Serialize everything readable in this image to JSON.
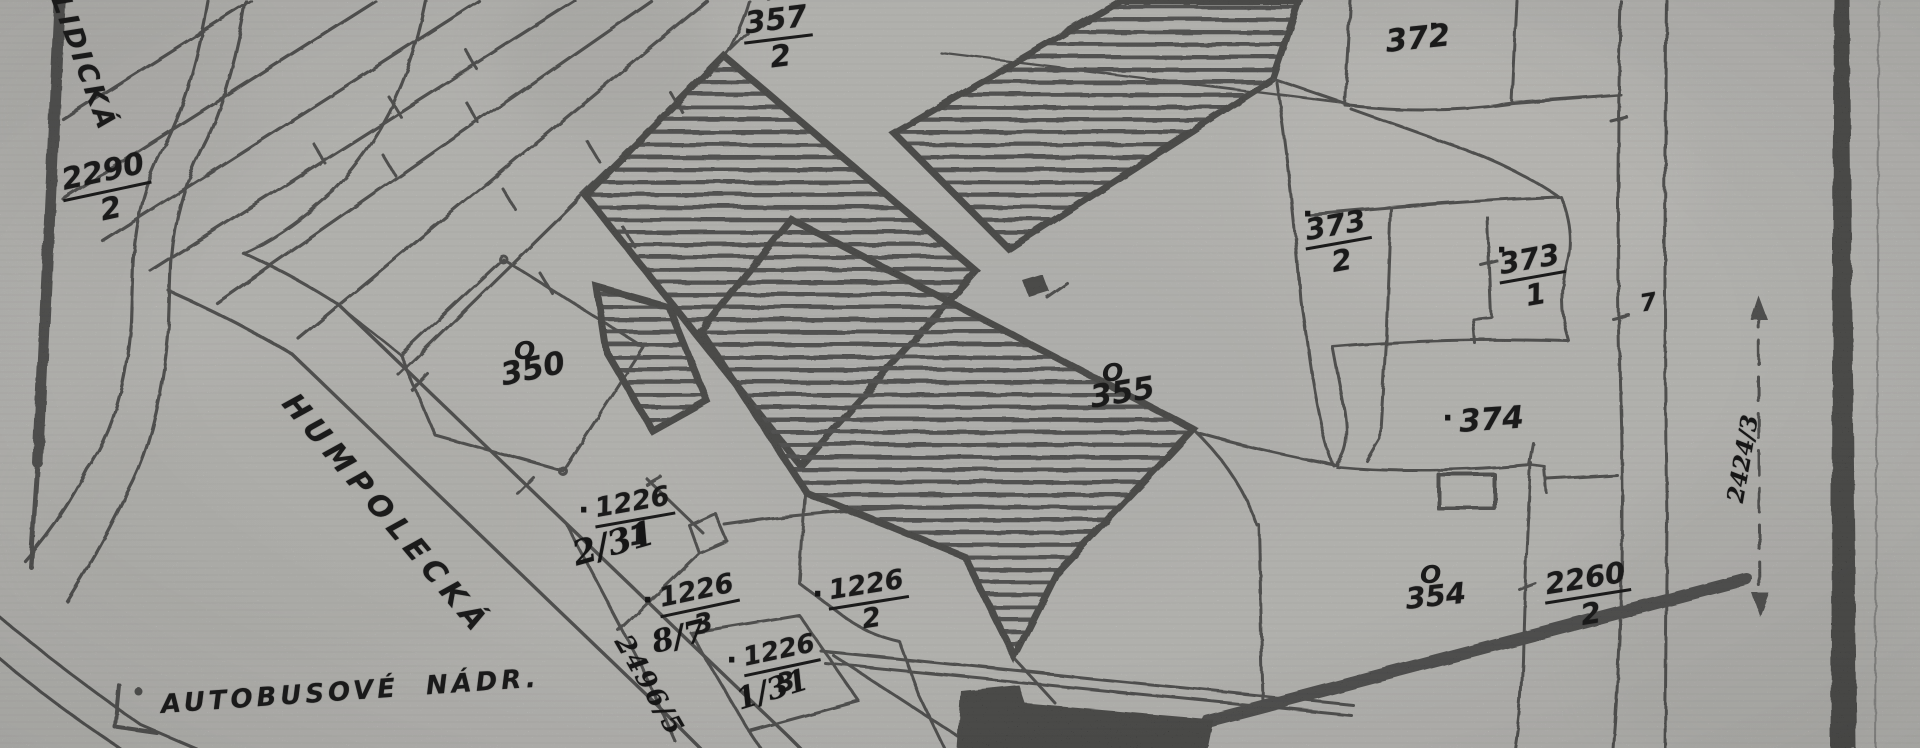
{
  "map": {
    "streets": {
      "lidicka": "LIDICKÁ",
      "humpolecka": "HUMPOLECKÁ",
      "autobusove_nadr": "AUTOBUSOVÉ NÁDR."
    },
    "symbols": {
      "orchard": "O",
      "house_dot": "·",
      "section_mark": "II"
    },
    "parcels": {
      "p2290_2": {
        "num": "2290",
        "den": "2"
      },
      "p357_2": {
        "num": "357",
        "den": "2"
      },
      "p372": {
        "text": "372"
      },
      "p373_2": {
        "num": "373",
        "den": "2"
      },
      "p373_1": {
        "num": "373",
        "den": "1"
      },
      "p374": {
        "text": "374"
      },
      "p350": {
        "text": "350"
      },
      "p355": {
        "text": "355"
      },
      "p354": {
        "text": "354"
      },
      "p2260_2": {
        "num": "2260",
        "den": "2"
      },
      "p2424_3": {
        "text": "2424/3"
      },
      "p7": {
        "text": "7"
      },
      "p2496_5": {
        "text": "2496/5"
      },
      "p1226_1": {
        "num": "1226",
        "den": "1",
        "annotation": "2/31"
      },
      "p1226_3a": {
        "num": "1226",
        "den": "3",
        "annotation": "8/7"
      },
      "p1226_2": {
        "num": "1226",
        "den": "2"
      },
      "p1226_3b": {
        "num": "1226",
        "den": "3",
        "annotation": "1/31"
      }
    },
    "colors": {
      "paper": "#d7d6d3",
      "ink": "#181818"
    }
  }
}
